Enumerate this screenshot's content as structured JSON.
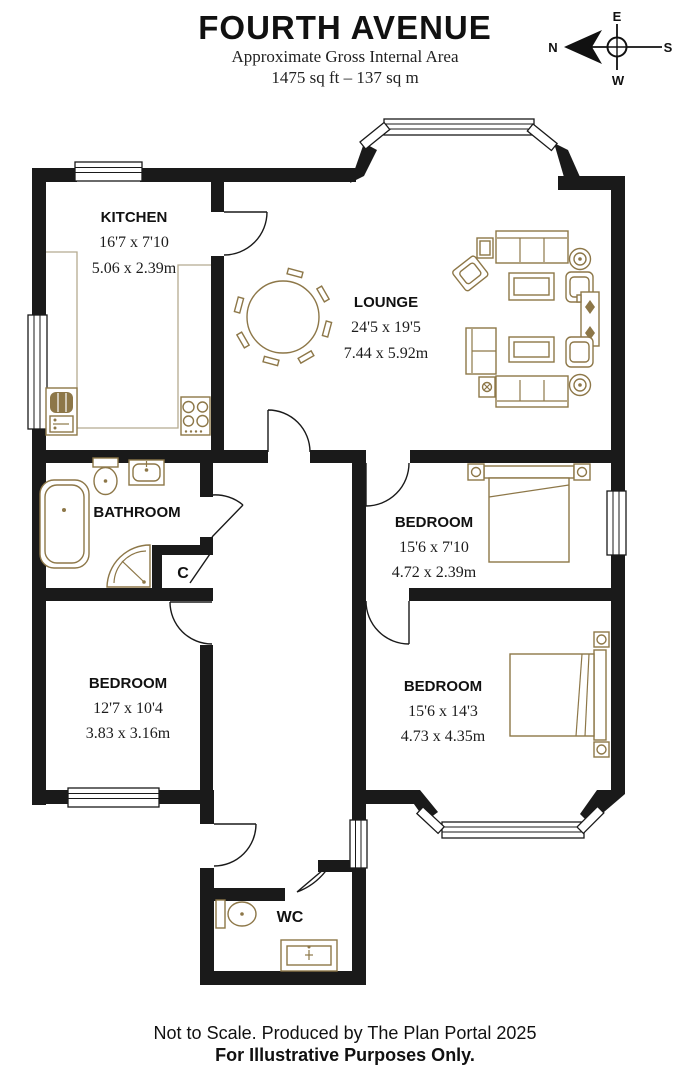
{
  "header": {
    "title": "FOURTH AVENUE",
    "subtitle": "Approximate Gross Internal Area",
    "area": "1475 sq ft – 137 sq m"
  },
  "compass": {
    "n": "N",
    "e": "E",
    "s": "S",
    "w": "W"
  },
  "rooms": {
    "kitchen": {
      "name": "KITCHEN",
      "imperial": "16'7 x 7'10",
      "metric": "5.06 x 2.39m"
    },
    "lounge": {
      "name": "LOUNGE",
      "imperial": "24'5 x 19'5",
      "metric": "7.44 x 5.92m"
    },
    "bathroom": {
      "name": "BATHROOM"
    },
    "bedroom_right": {
      "name": "BEDROOM",
      "imperial": "15'6 x 7'10",
      "metric": "4.72 x 2.39m"
    },
    "bedroom_left": {
      "name": "BEDROOM",
      "imperial": "12'7 x 10'4",
      "metric": "3.83 x 3.16m"
    },
    "bedroom_bottom": {
      "name": "BEDROOM",
      "imperial": "15'6 x 14'3",
      "metric": "4.73 x 4.35m"
    },
    "wc": {
      "name": "WC"
    },
    "cupboard": {
      "name": "C"
    }
  },
  "footer": {
    "line1": "Not to Scale. Produced by The Plan Portal 2025",
    "line2": "For Illustrative Purposes Only."
  },
  "colors": {
    "wall": "#1a1a1a",
    "furniture": "#8d7748",
    "background": "#ffffff"
  }
}
